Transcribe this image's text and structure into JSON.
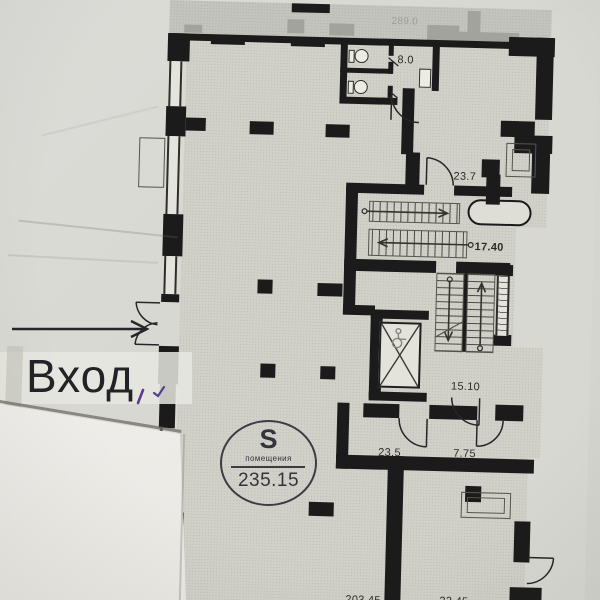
{
  "plan_photo": {
    "entrance": {
      "label": "Вход"
    },
    "stamp": {
      "symbol": "S",
      "caption": "помещения",
      "value": "235.15"
    },
    "labels": {
      "upper_area": "289.0",
      "wc": "8.0",
      "room_23_7": "23.7",
      "stairwell_main": "17.40",
      "stairwell_secondary": "15.10",
      "hall_23_5": "23.5",
      "hall_7_75": "7.75",
      "room_203_45": "203.45",
      "room_23_45": "23.45"
    },
    "colors": {
      "paper": "#d8d8d2",
      "plan_floor": "#d1d1c9",
      "faded_plan": "#c4c4be",
      "wall_ink": "#1b1b1b",
      "label_ink": "#2b2b2b",
      "stamp_ink": "#34343c",
      "pen_mark": "#5b3e8e",
      "overlay_sheet": "#edece8"
    }
  }
}
